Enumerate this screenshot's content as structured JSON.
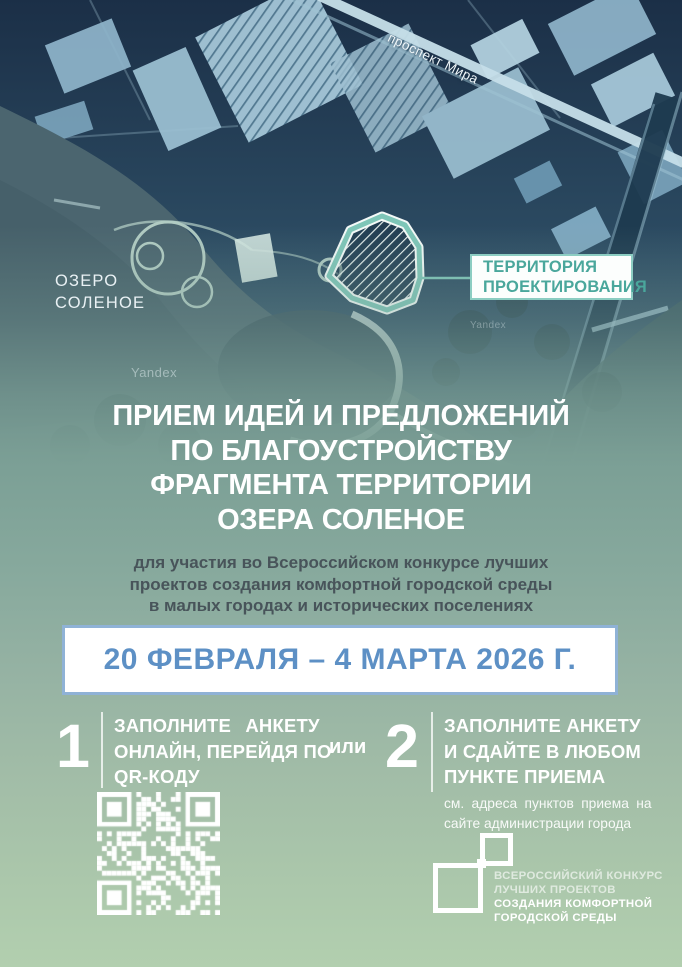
{
  "poster": {
    "map": {
      "street_label": "проспект Мира",
      "lake_label_line1": "ОЗЕРО",
      "lake_label_line2": "СОЛЕНОЕ",
      "territory_callout_line1": "ТЕРРИТОРИЯ",
      "territory_callout_line2": "ПРОЕКТИРОВАНИЯ",
      "watermark": "Yandex"
    },
    "heading_lines": [
      "ПРИЕМ ИДЕЙ И ПРЕДЛОЖЕНИЙ",
      "ПО БЛАГОУСТРОЙСТВУ",
      "ФРАГМЕНТА ТЕРРИТОРИИ",
      "ОЗЕРА СОЛЕНОЕ"
    ],
    "subtitle_lines": [
      "для участия во Всероссийском конкурсе лучших",
      "проектов создания комфортной городской среды",
      "в малых городах и исторических поселениях"
    ],
    "date_banner": "20 ФЕВРАЛЯ – 4 МАРТА 2026 Г.",
    "or_label": "или",
    "step1": {
      "number": "1",
      "lines": [
        "ЗАПОЛНИТЕ АНКЕТУ",
        "ОНЛАЙН, ПЕРЕЙДЯ ПО",
        "QR-КОДУ"
      ]
    },
    "step2": {
      "number": "2",
      "lines": [
        "ЗАПОЛНИТЕ АНКЕТУ",
        "И СДАЙТЕ В ЛЮБОМ",
        "ПУНКТЕ ПРИЕМА"
      ],
      "note_lines": [
        "см. адреса пунктов приема на",
        "сайте администрации города"
      ]
    },
    "qr_icon": "qr-code",
    "logo_lines": [
      "ВСЕРОССИЙСКИЙ КОНКУРС",
      "ЛУЧШИХ ПРОЕКТОВ",
      "СОЗДАНИЯ КОМФОРТНОЙ",
      "ГОРОДСКОЙ СРЕДЫ"
    ],
    "colors": {
      "date_accent": "#5d90c5",
      "date_border": "#8fb2d6",
      "territory_accent": "#4aa79c",
      "territory_border": "#8ccdc2",
      "map_tone": "#2e4c63",
      "background_bottom": "#b2cfaf"
    }
  }
}
